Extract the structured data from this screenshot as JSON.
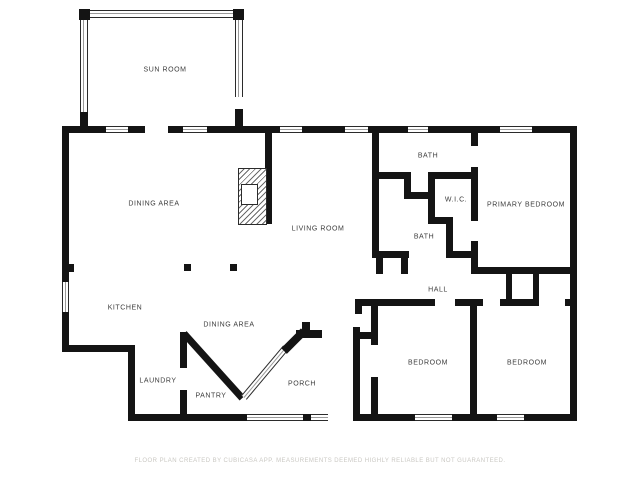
{
  "title": "Floor plan",
  "colors": {
    "wall": "#141414",
    "background": "#ffffff",
    "label_text": "#3c3c3c",
    "disclaimer_text": "#cac8c3"
  },
  "rooms": [
    {
      "label": "SUN ROOM"
    },
    {
      "label": "DINING AREA"
    },
    {
      "label": "LIVING ROOM"
    },
    {
      "label": "BATH"
    },
    {
      "label": "W.I.C."
    },
    {
      "label": "PRIMARY BEDROOM"
    },
    {
      "label": "BATH"
    },
    {
      "label": "KITCHEN"
    },
    {
      "label": "DINING AREA"
    },
    {
      "label": "HALL"
    },
    {
      "label": "LAUNDRY"
    },
    {
      "label": "PANTRY"
    },
    {
      "label": "PORCH"
    },
    {
      "label": "BEDROOM"
    },
    {
      "label": "BEDROOM"
    }
  ],
  "features": [
    {
      "name": "fireplace"
    },
    {
      "name": "porch-railing"
    },
    {
      "name": "support-columns"
    }
  ],
  "footer": {
    "disclaimer": "FLOOR PLAN CREATED BY CUBICASA APP. MEASUREMENTS DEEMED HIGHLY RELIABLE BUT NOT GUARANTEED."
  }
}
